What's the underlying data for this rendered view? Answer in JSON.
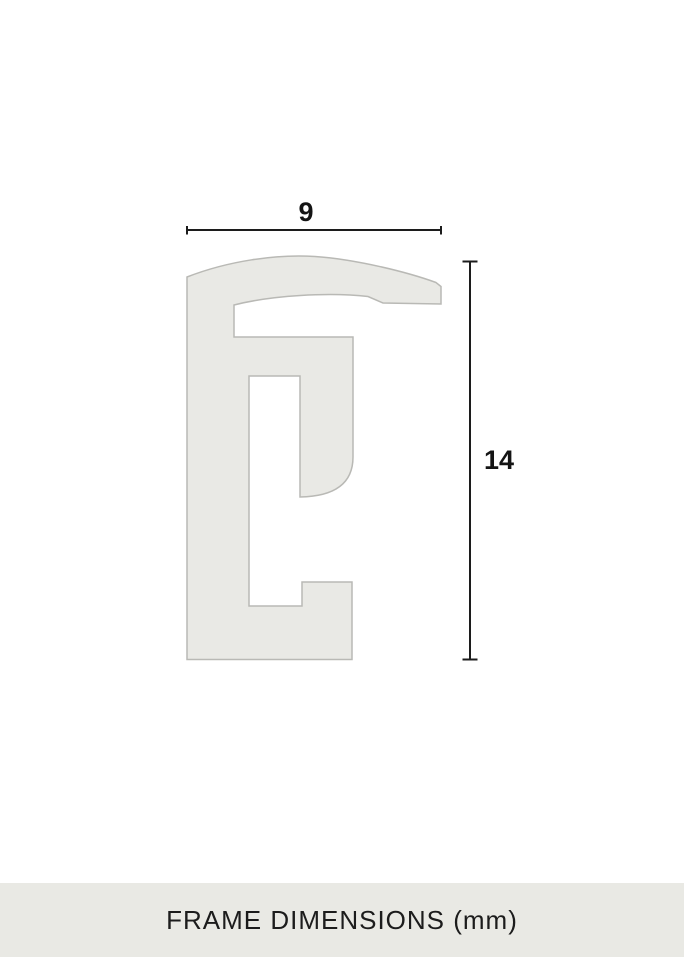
{
  "dimensions": {
    "width": {
      "label": "9"
    },
    "height": {
      "label": "14"
    }
  },
  "footer": {
    "title": "FRAME DIMENSIONS (mm)"
  },
  "colors": {
    "background": "#ffffff",
    "profile_fill": "#e9e9e5",
    "profile_stroke": "#b9b9b5",
    "dimension_line": "#1c1c1c",
    "label_text": "#141414",
    "footer_bg": "#e9e9e4",
    "footer_text": "#1c1c1c"
  }
}
